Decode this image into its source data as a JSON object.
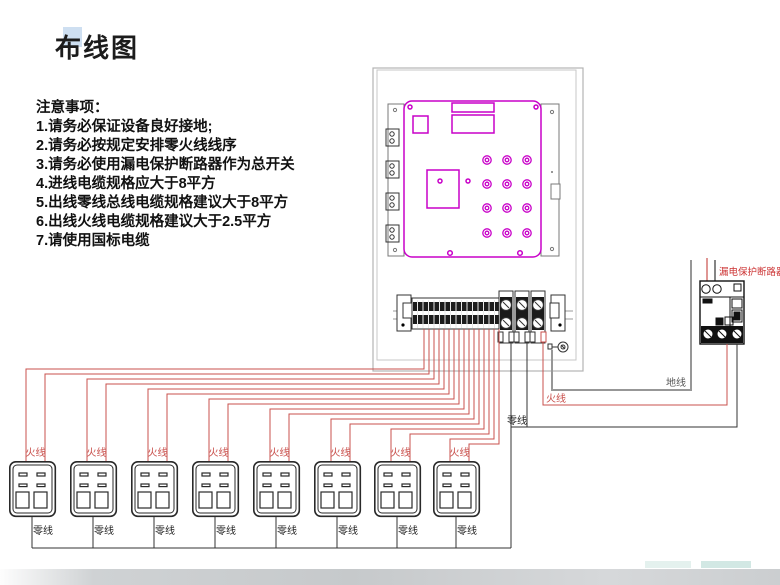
{
  "page": {
    "title": "布线图"
  },
  "notes": {
    "heading": "注意事项：",
    "items": [
      "1.请务必保证设备良好接地;",
      "2.请务必按规定安排零火线线序",
      "3.请务必使用漏电保护断路器作为总开关",
      "4.进线电缆规格应大于8平方",
      "5.出线零线总线电缆规格建议大于8平方",
      "6.出线火线电缆规格建议大于2.5平方",
      "7.请使用国标电缆"
    ]
  },
  "labels": {
    "live": "火线",
    "neutral": "零线",
    "ground": "地线",
    "breaker": "漏电保护断路器"
  },
  "colors": {
    "live_wire": "#c9504c",
    "neutral_wire": "#333333",
    "ground_wire": "#979797",
    "panel_outline": "#c800c8",
    "breaker_label": "#cc3333",
    "title_highlight": "#c5d9ee"
  },
  "counts": {
    "outlets": 8
  }
}
